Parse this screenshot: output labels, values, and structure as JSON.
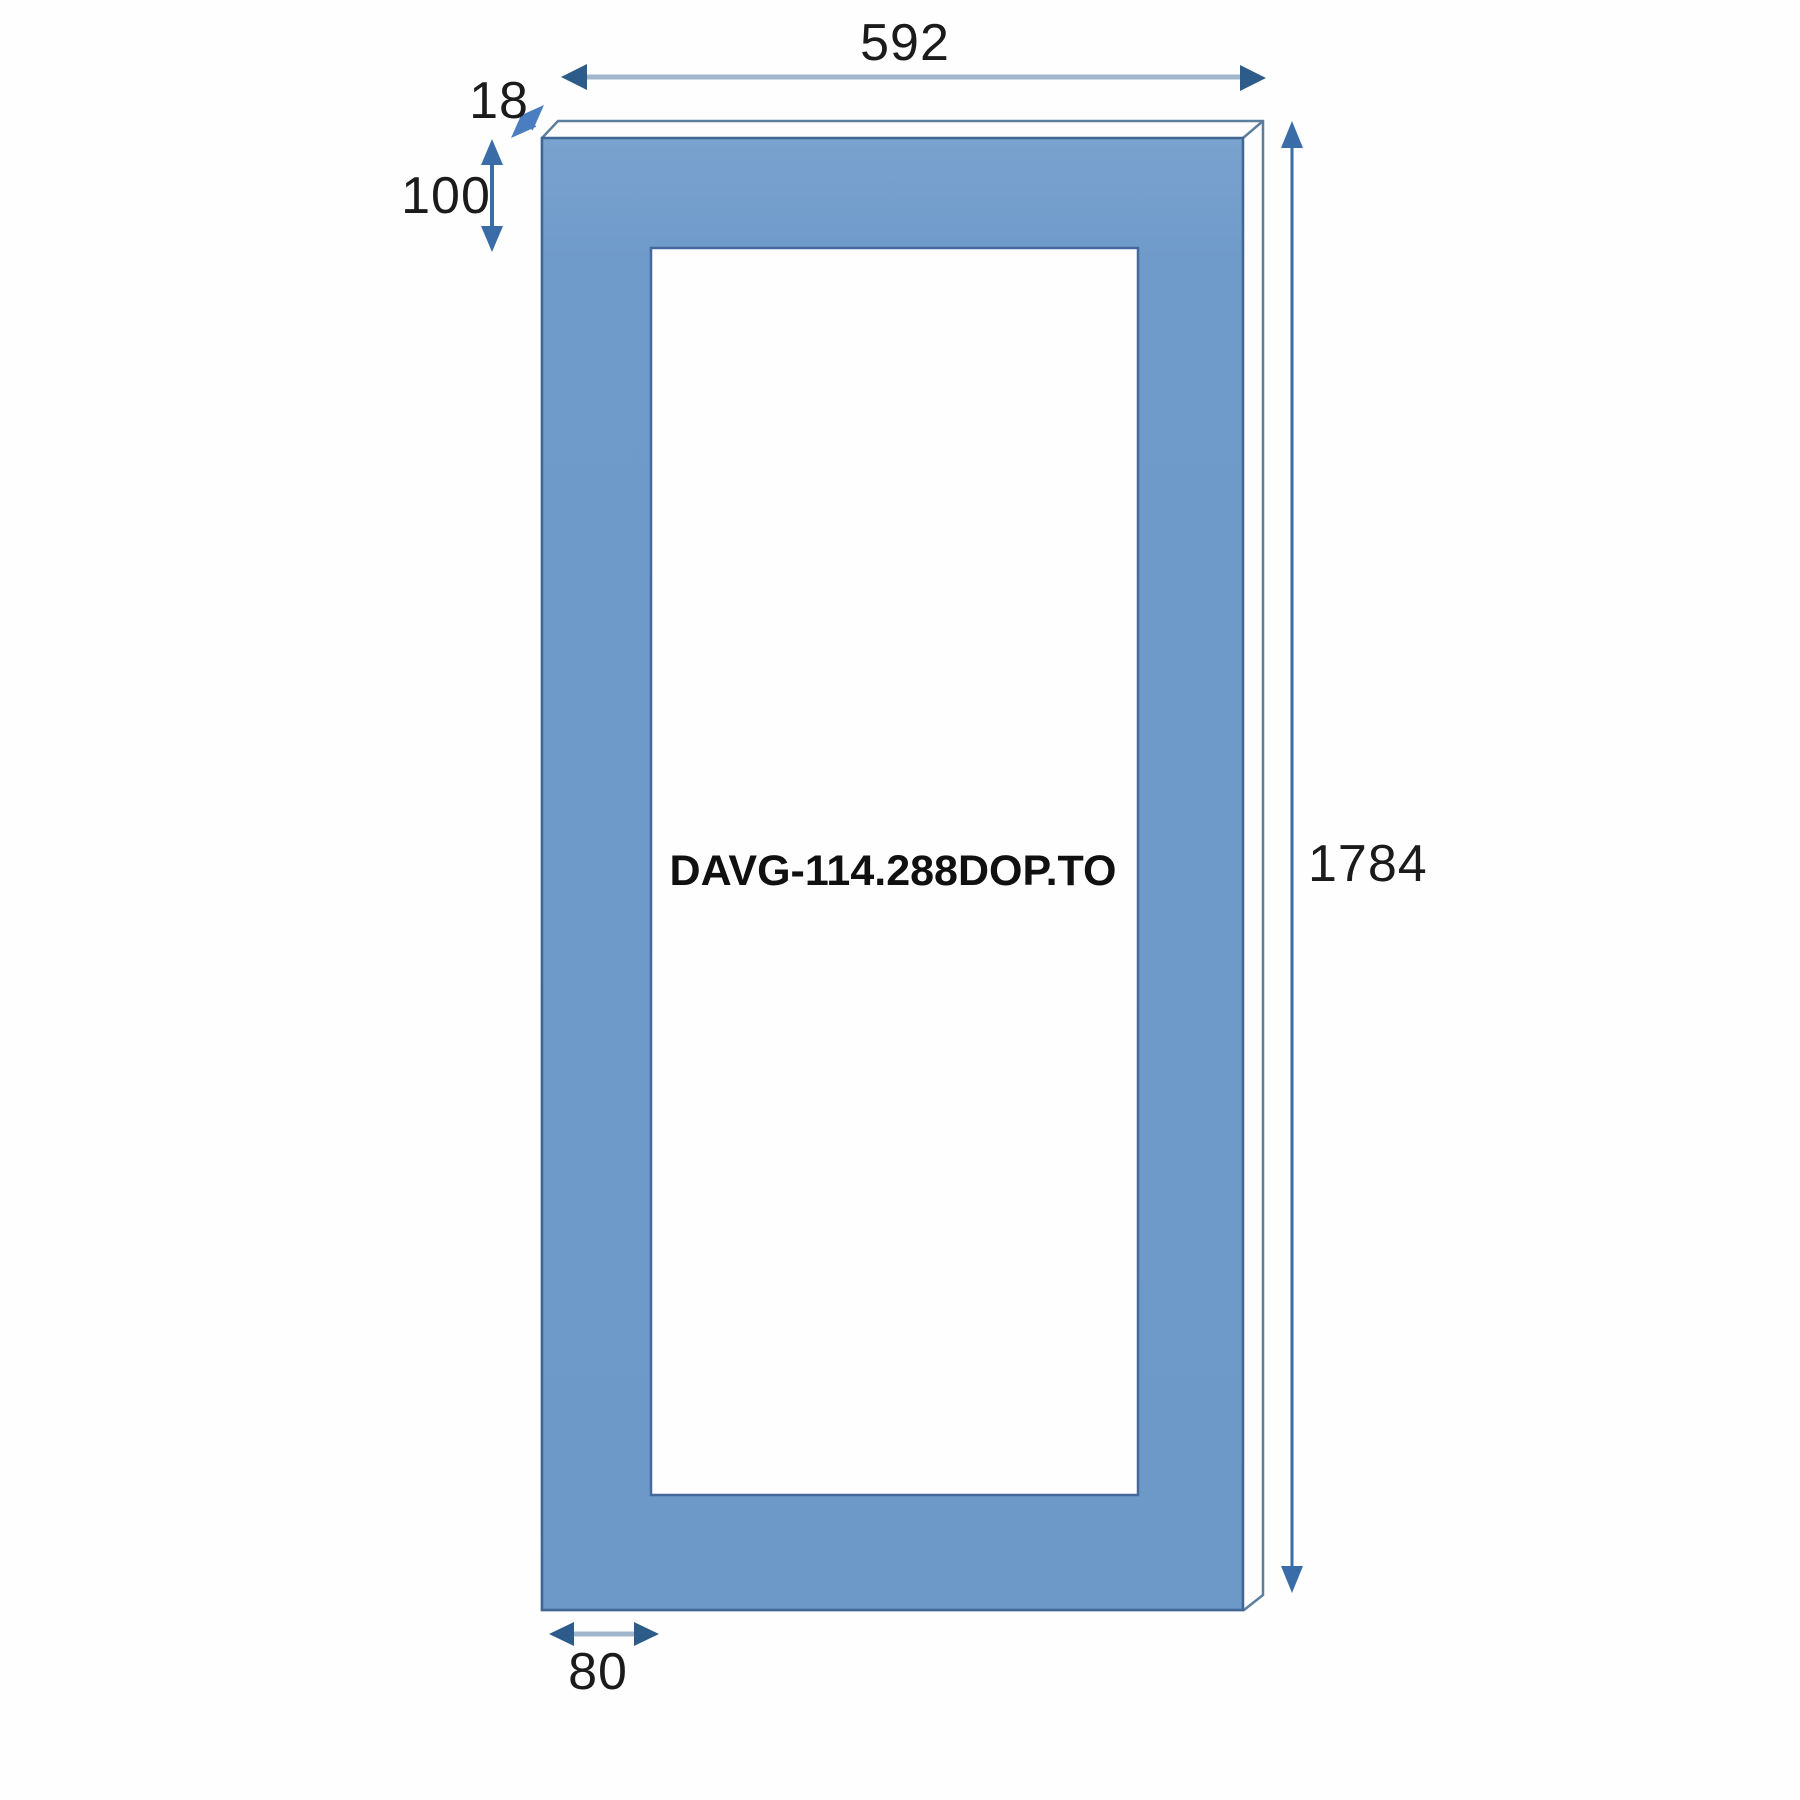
{
  "drawing": {
    "part_number": "DAVG-114.288DOP.TO",
    "dimensions": {
      "width": "592",
      "edge_thickness": "18",
      "top_rail": "100",
      "height": "1784",
      "bottom_stile": "80"
    },
    "colors": {
      "face_fill": "#6c99c8",
      "face_stroke": "#3f6694",
      "edge_outline": "#5d7f9e",
      "cutout_stroke": "#46699b",
      "dim_line_light": "#9fb6cb",
      "dim_arrow_dark": "#2e5c8a",
      "dim_blue": "#3a6ca8",
      "thickness_arrow_blue": "#4a7ec0",
      "label_color": "#1b1b1b"
    }
  }
}
